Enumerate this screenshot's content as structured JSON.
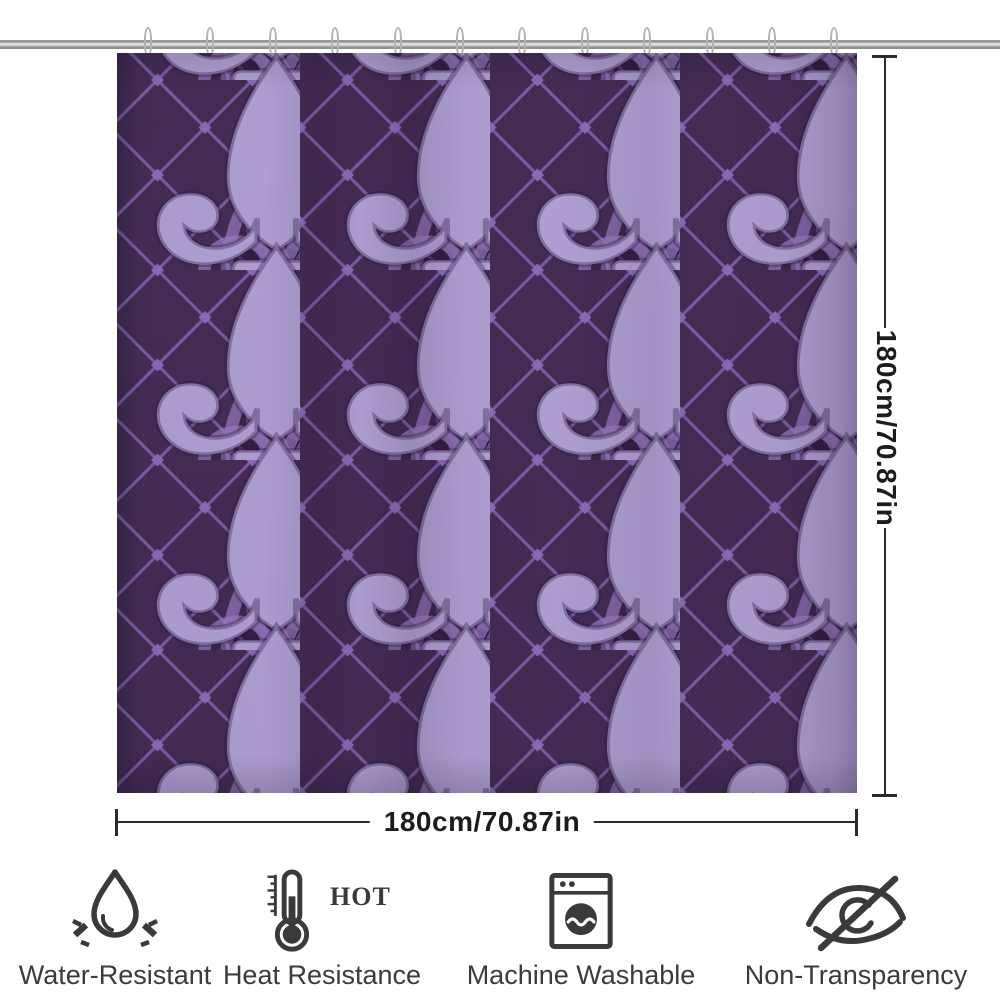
{
  "product": {
    "type": "shower-curtain-preview",
    "pattern": "fleur-de-lis-diamond-lattice"
  },
  "dimensions": {
    "width_label": "180cm/70.87in",
    "height_label": "180cm/70.87in"
  },
  "features": [
    {
      "icon": "water-drop-icon",
      "label": "Water-Resistant"
    },
    {
      "icon": "thermometer-hot-icon",
      "label": "Heat Resistance",
      "hot_label": "HOT"
    },
    {
      "icon": "washing-machine-icon",
      "label": "Machine Washable"
    },
    {
      "icon": "eye-slash-icon",
      "label": "Non-Transparency"
    }
  ],
  "colors": {
    "page_background": "#ffffff",
    "curtain_background": "#452c55",
    "lattice_line": "#7c5ea8",
    "lattice_dot": "#8d6dbd",
    "fleur_outline": "#9a7cc4",
    "fleur_bright": "#b3a2d6",
    "rod_gray": "#c9c9c9",
    "dimension_color": "#2a2a2a",
    "icon_color": "#3a3a3a",
    "label_color": "#3b3b3b"
  }
}
